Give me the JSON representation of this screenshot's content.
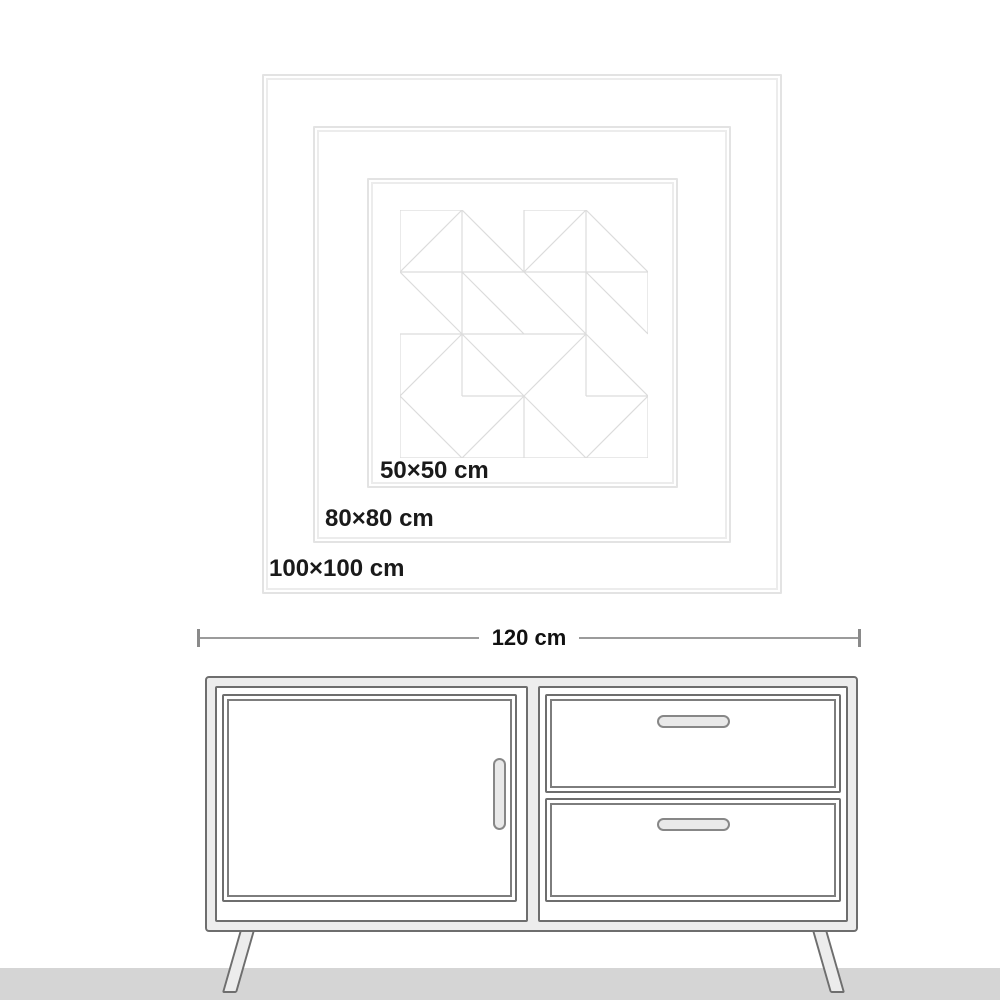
{
  "artwork": {
    "size_labels": [
      {
        "id": "50",
        "label": "50×50 cm"
      },
      {
        "id": "80",
        "label": "80×80 cm"
      },
      {
        "id": "100",
        "label": "100×100 cm"
      }
    ],
    "frame_line_color": "#e3e3e3",
    "pattern_line_color": "#dcdcdc",
    "pattern_path": "M0 0H62M124 0H186M0 62H248M0 124H186M62 186H124M186 186H248M0 248H248M0 0V62M0 124V248M62 0V186M124 0V62M124 186V248M186 0V186M248 62V124M248 186V248M62 0L124 62M186 0L248 62M0 62L62 124M62 62L124 124M124 62L186 124M186 62L248 124M62 124L124 186M0 186L62 248M186 124L248 186M124 186L186 248M62 0L0 62M186 0L124 62M0 186L62 124M62 248L124 186M124 186L186 124M186 248L248 186"
  },
  "dimension": {
    "label": "120 cm",
    "line_color": "#9b9b9b",
    "tick_color": "#8a8a8a"
  },
  "sideboard": {
    "outline_color": "#6e6e6e",
    "body_fill": "#ededed",
    "panel_fill": "#ffffff",
    "handle_fill": "#e9e9e9"
  },
  "floor": {
    "color": "#d5d5d5"
  }
}
